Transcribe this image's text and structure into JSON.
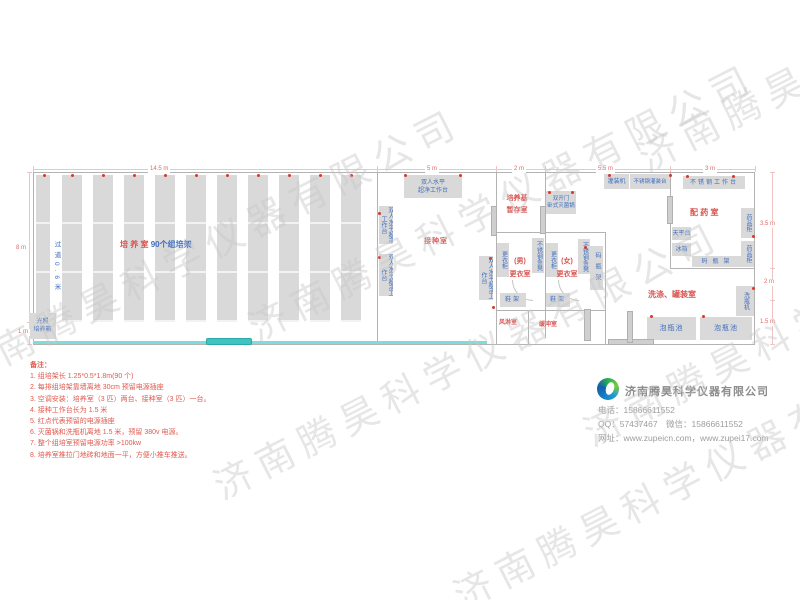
{
  "watermark": {
    "text": "济南腾昊科学仪器有限公司"
  },
  "plan": {
    "dims": {
      "top_total": "14.5 m",
      "top_inoculation": "5 m",
      "top_storage": "2 m",
      "top_mid": "5.5 m",
      "top_dispensing": "3 m",
      "right_dispensing": "3.5 m",
      "right_wash": "2 m",
      "right_pool": "1.5 m",
      "left_main": "8 m",
      "left_bottom": "1 m"
    },
    "rooms": {
      "culture_name": "培 养 室",
      "culture_racks": "90个组培架",
      "aisle": "过道0.6米",
      "inoculation": "接种室",
      "storage_l1": "培养基",
      "storage_l2": "暂存室",
      "mens_l1": "(男)",
      "mens_l2": "更衣室",
      "womens_l1": "(女)",
      "womens_l2": "更衣室",
      "air_shower": "风淋室",
      "buffer": "缓冲室",
      "dispensing": "配 药 室",
      "washing": "洗涤、罐装室"
    },
    "equipment": {
      "incubator_l1": "光照",
      "incubator_l2": "培养箱",
      "clean_bench_l1": "双人水平",
      "clean_bench_l2": "超净工作台",
      "clean_bench_v": "双人水平超净工作台",
      "sterilizer_l1": "双开门",
      "sterilizer_l2": "卧式灭菌锅",
      "locker": "更衣柜",
      "ss_bench": "不锈钢条凳",
      "shoe_rack": "鞋架",
      "bottle_rack": "码瓶架",
      "filler": "灌装机",
      "filling_table": "不锈钢灌装台",
      "worktable": "不锈钢工作台",
      "medicine_cabinet": "药品柜",
      "balance": "天平台",
      "fridge": "冰箱",
      "bottle_washer": "洗瓶机",
      "soak_pool": "泡瓶池"
    }
  },
  "notes": {
    "title": "备注：",
    "items": [
      "1.  组培架长 1.25*0.5*1.8m(90 个)",
      "2.  每排组培架靠墙离地 30cm 预留电源插座",
      "3.  空调安装：培养室（3 匹）两台、接种室（3 匹）一台。",
      "4.  接种工作台长为 1.5 米",
      "5.  红点代表预留的电源插座",
      "6.  灭菌锅和洗瓶机离地 1.5 米，预留 380v 电源。",
      "7.  整个组培室预留电源功率 >100kw",
      "8.  培养室推拉门地砖和地面一平，方便小推车推送。"
    ]
  },
  "company": {
    "name": "济南腾昊科学仪器有限公司",
    "phone": "电话：15866611552",
    "qq_wechat": "QQ：57437467　微信：15866611552",
    "web": "网址：www.zupeicn.com，www.zupei17.com"
  }
}
